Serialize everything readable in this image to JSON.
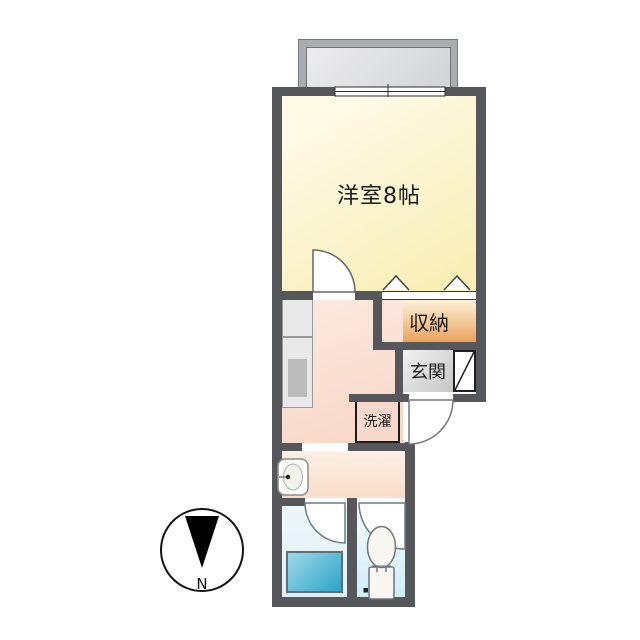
{
  "rooms": {
    "western_room": {
      "label": "洋室8帖",
      "color": "#f8eeb4"
    },
    "closet": {
      "label": "収納",
      "color": "#eba25a"
    },
    "entrance": {
      "label": "玄関",
      "color": "#d9d9db"
    },
    "laundry": {
      "label": "洗濯",
      "color": "#f8d8ca"
    },
    "hall": {
      "color": "#f8d7c6"
    },
    "washroom": {
      "color": "#f9dcc8"
    },
    "bath": {
      "color": "#e0f1f6"
    },
    "bathtub": {
      "color": "#2da4c9"
    },
    "toilet": {
      "color": "#cfeef8"
    },
    "balcony": {
      "color": "#aaacae"
    }
  },
  "walls": {
    "color": "#55575a"
  },
  "compass": {
    "label": "N",
    "direction": "north-down"
  }
}
